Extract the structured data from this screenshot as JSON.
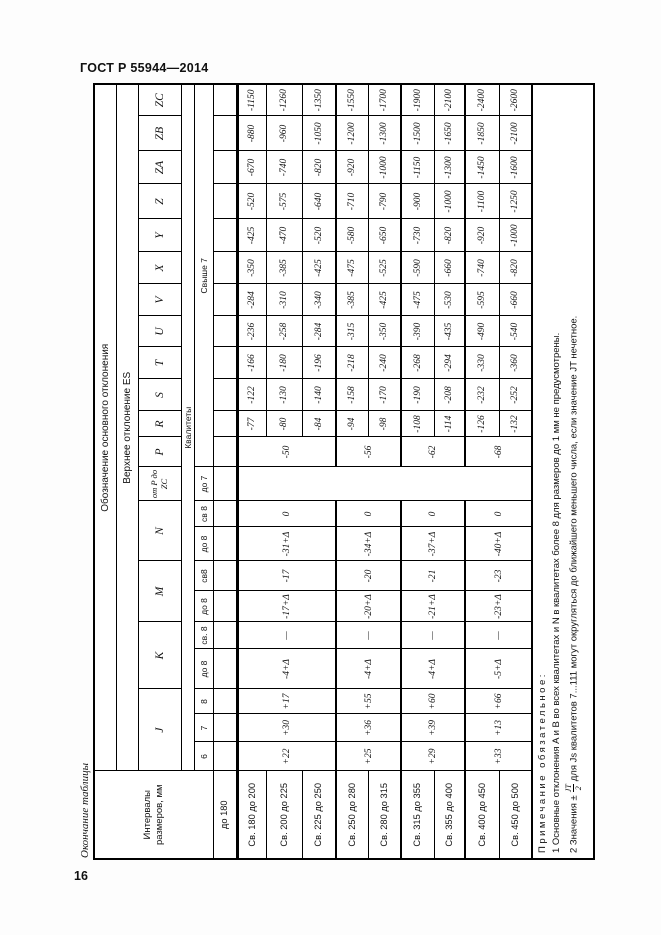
{
  "page": {
    "standard": "ГОСТ Р 55944—2014",
    "page_number": "16",
    "table_caption": "Окончание таблицы"
  },
  "table": {
    "headers": {
      "intervals": "Интервалы размеров, мм",
      "designation": "Обозначение основного отклонения",
      "upper_deviation": "Верхнее отклонение ES",
      "kvalitety": "Квалитеты",
      "letters": {
        "J": "J",
        "K": "K",
        "M": "M",
        "N": "N",
        "PZC": "от P до ZC",
        "P": "P",
        "R": "R",
        "S": "S",
        "T": "T",
        "U": "U",
        "V": "V",
        "X": "X",
        "Y": "Y",
        "Z": "Z",
        "ZA": "ZA",
        "ZB": "ZB",
        "ZC": "ZC"
      },
      "grades": {
        "j6": "6",
        "j7": "7",
        "j8": "8",
        "k_do": "до 8",
        "k_sv": "св. 8",
        "m_do": "до 8",
        "m_sv": "св8",
        "n_do": "до 8",
        "n_sv": "св 8",
        "pzc_do": "до 7",
        "above7": "Свыше 7"
      }
    },
    "intervals": [
      "до 180",
      "Св. 180 до 200",
      "Св. 200 до 225",
      "Св. 225 до 250",
      "Св. 250 до 280",
      "Св. 280 до 315",
      "Св. 315 до 355",
      "Св. 355 до 400",
      "Св. 400 до 450",
      "Св. 450 до 500"
    ],
    "grouped": {
      "J6": [
        "+22",
        "+25",
        "+29",
        "+33"
      ],
      "J7": [
        "+30",
        "+36",
        "+39",
        "+13"
      ],
      "J8": [
        "+17",
        "+55",
        "+60",
        "+66"
      ],
      "K_do8": [
        "-4+Δ",
        "-4+Δ",
        "-4+Δ",
        "-5+Δ"
      ],
      "K_sv8": [
        "—",
        "—",
        "—",
        "—"
      ],
      "M_do8": [
        "-17+Δ",
        "-20+Δ",
        "-21+Δ",
        "-23+Δ"
      ],
      "M_sv8": [
        "-17",
        "-20",
        "-21",
        "-23"
      ],
      "N_do8": [
        "-31+Δ",
        "-34+Δ",
        "-37+Δ",
        "-40+Δ"
      ],
      "N_sv8": [
        "0",
        "0",
        "0",
        "0"
      ],
      "P": [
        "-50",
        "-56",
        "-62",
        "-68"
      ]
    },
    "per_interval": {
      "R": [
        "-77",
        "-80",
        "-84",
        "-94",
        "-98",
        "-108",
        "-114",
        "-126",
        "-132"
      ],
      "S": [
        "-122",
        "-130",
        "-140",
        "-158",
        "-170",
        "-190",
        "-208",
        "-232",
        "-252"
      ],
      "T": [
        "-166",
        "-180",
        "-196",
        "-218",
        "-240",
        "-268",
        "-294",
        "-330",
        "-360"
      ],
      "U": [
        "-236",
        "-258",
        "-284",
        "-315",
        "-350",
        "-390",
        "-435",
        "-490",
        "-540"
      ],
      "V": [
        "-284",
        "-310",
        "-340",
        "-385",
        "-425",
        "-475",
        "-530",
        "-595",
        "-660"
      ],
      "X": [
        "-350",
        "-385",
        "-425",
        "-475",
        "-525",
        "-590",
        "-660",
        "-740",
        "-820"
      ],
      "Y": [
        "-425",
        "-470",
        "-520",
        "-580",
        "-650",
        "-730",
        "-820",
        "-920",
        "-1000"
      ],
      "Z": [
        "-520",
        "-575",
        "-640",
        "-710",
        "-790",
        "-900",
        "-1000",
        "-1100",
        "-1250"
      ],
      "ZA": [
        "-670",
        "-740",
        "-820",
        "-920",
        "-1000",
        "-1150",
        "-1300",
        "-1450",
        "-1600"
      ],
      "ZB": [
        "-880",
        "-960",
        "-1050",
        "-1200",
        "-1300",
        "-1500",
        "-1650",
        "-1850",
        "-2100"
      ],
      "ZC": [
        "-1150",
        "-1260",
        "-1350",
        "-1550",
        "-1700",
        "-1900",
        "-2100",
        "-2400",
        "-2600"
      ]
    },
    "notes": {
      "title": "Примечание обязательное:",
      "note1": "1 Основные отклонения A и B во всех квалитетах и N в квалитетах более 8 для размеров до 1 мм не предусмотрены.",
      "note2_prefix": "2 Значения ±",
      "note2_frac_num": "JT",
      "note2_frac_den": "2",
      "note2_suffix": "для Js квалитетов 7...111 могут округляться до ближайшего меньшего числа, если значение JT нечетное."
    }
  }
}
